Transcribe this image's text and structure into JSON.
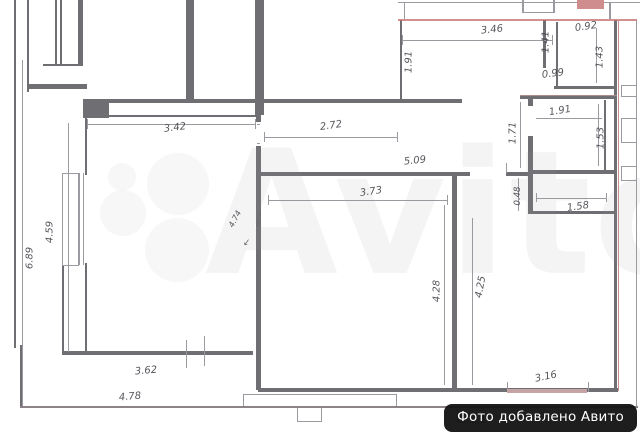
{
  "watermark": {
    "brand": "Avito"
  },
  "badge": {
    "label": "Фото добавлено Авито"
  },
  "icons": {
    "leader_arrow": "↙"
  },
  "colors": {
    "wall_gray": "#6f6f73",
    "thin_line": "#9a9aa0",
    "boundary_red": "#c36b6b",
    "red_block": "#cf8d8d",
    "hatch_pink": "#c7a4a4",
    "dim_text": "#3f3f46",
    "badge_bg": "#121212",
    "badge_text": "#ffffff"
  },
  "plan": {
    "type": "apartment-floor-plan",
    "dimension_unit": "m",
    "dims": [
      {
        "t": "3.42",
        "x": 175,
        "y": 128,
        "r": -7
      },
      {
        "t": "2.72",
        "x": 331,
        "y": 126,
        "r": -8
      },
      {
        "t": "3.46",
        "x": 492,
        "y": 30,
        "r": -6
      },
      {
        "t": "0.92",
        "x": 586,
        "y": 27,
        "r": -8
      },
      {
        "t": "1.43",
        "x": 600,
        "y": 57,
        "r": -90
      },
      {
        "t": "1.41",
        "x": 546,
        "y": 42,
        "r": -90
      },
      {
        "t": "0.99",
        "x": 553,
        "y": 74,
        "r": -7
      },
      {
        "t": "1.91",
        "x": 409,
        "y": 62,
        "r": -90
      },
      {
        "t": "1.91",
        "x": 560,
        "y": 111,
        "r": -9
      },
      {
        "t": "1.71",
        "x": 513,
        "y": 133,
        "r": -90
      },
      {
        "t": "1.53",
        "x": 601,
        "y": 138,
        "r": -90
      },
      {
        "t": "5.09",
        "x": 415,
        "y": 161,
        "r": -6
      },
      {
        "t": "3.73",
        "x": 371,
        "y": 192,
        "r": -8
      },
      {
        "t": "0.48",
        "x": 518,
        "y": 196,
        "r": -90,
        "s": 8.5
      },
      {
        "t": "1.58",
        "x": 578,
        "y": 207,
        "r": -8
      },
      {
        "t": "4.28",
        "x": 437,
        "y": 291,
        "r": -90
      },
      {
        "t": "4.25",
        "x": 481,
        "y": 287,
        "r": -80
      },
      {
        "t": "4.74",
        "x": 235,
        "y": 219,
        "r": -62,
        "s": 8
      },
      {
        "t": "4.59",
        "x": 50,
        "y": 232,
        "r": -90
      },
      {
        "t": "6.89",
        "x": 30,
        "y": 258,
        "r": -90
      },
      {
        "t": "3.62",
        "x": 146,
        "y": 371,
        "r": -5
      },
      {
        "t": "4.78",
        "x": 130,
        "y": 397,
        "r": -5
      },
      {
        "t": "3.16",
        "x": 546,
        "y": 377,
        "r": -12
      }
    ]
  }
}
